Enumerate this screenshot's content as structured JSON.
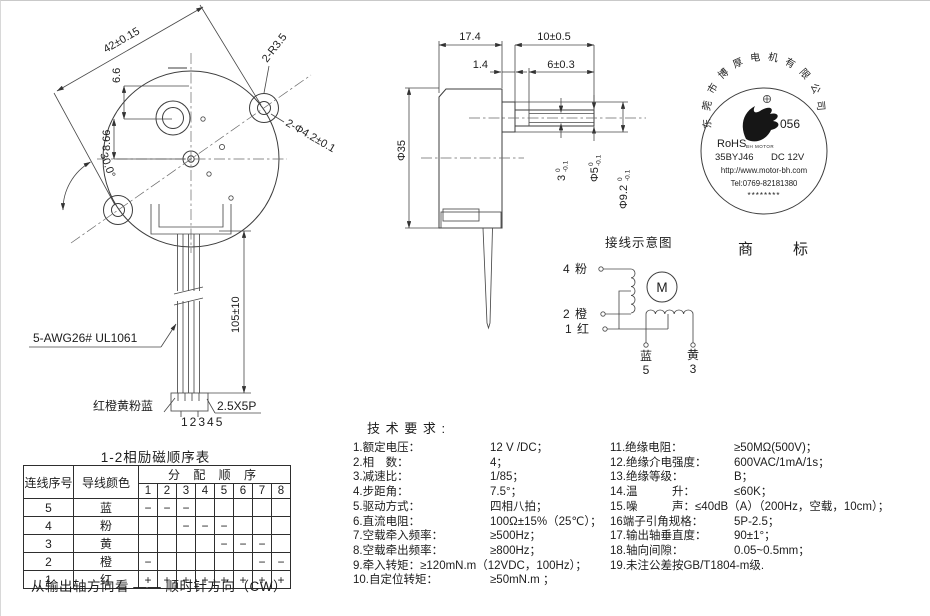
{
  "front_view": {
    "dim_diagonal": "42±0.15",
    "dim_66": "6.6",
    "dim_866": "8.66",
    "dim_angle": "30.0°",
    "dim_ears_radius": "2-R3.5",
    "dim_mount_holes": "2-Φ4.2±0.1",
    "dim_wire_length": "105±10",
    "wire_spec": "5-AWG26# UL1061",
    "wire_colors": "红橙黄粉蓝",
    "pin_numbers": "12345",
    "connector_spec": "2.5X5P"
  },
  "side_view": {
    "dim_body_depth": "17.4",
    "dim_boss_len": "1.4",
    "dim_shaft_len": "10±0.5",
    "dim_flat_len": "6±0.3",
    "dim_body_dia": "Φ35",
    "dim_flat": {
      "v": "3",
      "tol_top": "0",
      "tol_bot": "-0.1"
    },
    "dim_shaft_dia": {
      "v": "Φ5",
      "tol_top": "0",
      "tol_bot": "-0.1"
    },
    "dim_boss_dia": {
      "v": "Φ9.2",
      "tol_top": "0",
      "tol_bot": "-0.1"
    }
  },
  "stamp": {
    "company_arc": "东莞市博厚电机有限公司",
    "number": "056",
    "rohs": "RoHS",
    "brand_small": "BH MOTOR",
    "model": "35BYJ46",
    "voltage": "DC 12V",
    "website": "http://www.motor-bh.com",
    "phone": "Tel:0769-82181380",
    "stars": "********",
    "label": "商标"
  },
  "wiring": {
    "title": "接线示意图",
    "motor_symbol": "M",
    "terminals": [
      {
        "num": "4",
        "color": "粉"
      },
      {
        "num": "2",
        "color": "橙"
      },
      {
        "num": "1",
        "color": "红"
      }
    ],
    "bottom_terminals": [
      {
        "color": "蓝",
        "num": "5"
      },
      {
        "color": "黄",
        "num": "3"
      }
    ]
  },
  "sequence_table": {
    "title": "1-2相励磁顺序表",
    "col_wire_num": "连线序号",
    "col_wire_color": "导线颜色",
    "col_order": "分 配 顺 序",
    "steps": [
      "1",
      "2",
      "3",
      "4",
      "5",
      "6",
      "7",
      "8"
    ],
    "rows": [
      {
        "num": "5",
        "color": "蓝",
        "cells": [
          "−",
          "−",
          "−",
          "",
          "",
          "",
          "",
          ""
        ]
      },
      {
        "num": "4",
        "color": "粉",
        "cells": [
          "",
          "",
          "−",
          "−",
          "−",
          "",
          "",
          ""
        ]
      },
      {
        "num": "3",
        "color": "黄",
        "cells": [
          "",
          "",
          "",
          "",
          "−",
          "−",
          "−",
          ""
        ]
      },
      {
        "num": "2",
        "color": "橙",
        "cells": [
          "−",
          "",
          "",
          "",
          "",
          "",
          "−",
          "−"
        ]
      },
      {
        "num": "1",
        "color": "红",
        "cells": [
          "+",
          "+",
          "+",
          "+",
          "+",
          "+",
          "+",
          "+"
        ]
      }
    ],
    "note": "从输出轴方向看 —— 顺时针方向（CW）"
  },
  "tech_specs": {
    "title": "技 术 要 求 :",
    "left": [
      {
        "label": "1.额定电压：",
        "value": "12 V /DC；"
      },
      {
        "label": "2.相　数：",
        "value": "4；"
      },
      {
        "label": "3.减速比：",
        "value": "1/85；"
      },
      {
        "label": "4.步距角：",
        "value": "7.5°；"
      },
      {
        "label": "5.驱动方式：",
        "value": "四相八拍；"
      },
      {
        "label": "6.直流电阻：",
        "value": "100Ω±15%（25℃）；"
      },
      {
        "label": "7.空载牵入频率：",
        "value": "≥500Hz；"
      },
      {
        "label": "8.空载牵出频率：",
        "value": "≥800Hz；"
      },
      {
        "label": "9.牵入转矩：",
        "value": "≥120mN.m（12VDC，100Hz）；",
        "tight": true
      },
      {
        "label": "10.自定位转矩：",
        "value": "≥50mN.m ；"
      }
    ],
    "right": [
      {
        "label": "11.绝缘电阻：",
        "value": "≥50MΩ(500V)；"
      },
      {
        "label": "12.绝缘介电强度：",
        "value": "600VAC/1mA/1s；"
      },
      {
        "label": "13.绝缘等级：",
        "value": "B；"
      },
      {
        "label": "14.温　　　升：",
        "value": "≤60K；"
      },
      {
        "label": "15.噪　　　声：",
        "value": "≤40dB（A）（200Hz，空载，10cm）；",
        "tight": true,
        "wrap": true
      },
      {
        "label": "16端子引角规格：",
        "value": "5P-2.5；"
      },
      {
        "label": "17.输出轴垂直度：",
        "value": "90±1°；"
      },
      {
        "label": "18.轴向间隙：",
        "value": "0.05~0.5mm；"
      },
      {
        "label": "19.未注公差按GB/T1804-m级.",
        "value": "",
        "tight": true
      }
    ]
  }
}
